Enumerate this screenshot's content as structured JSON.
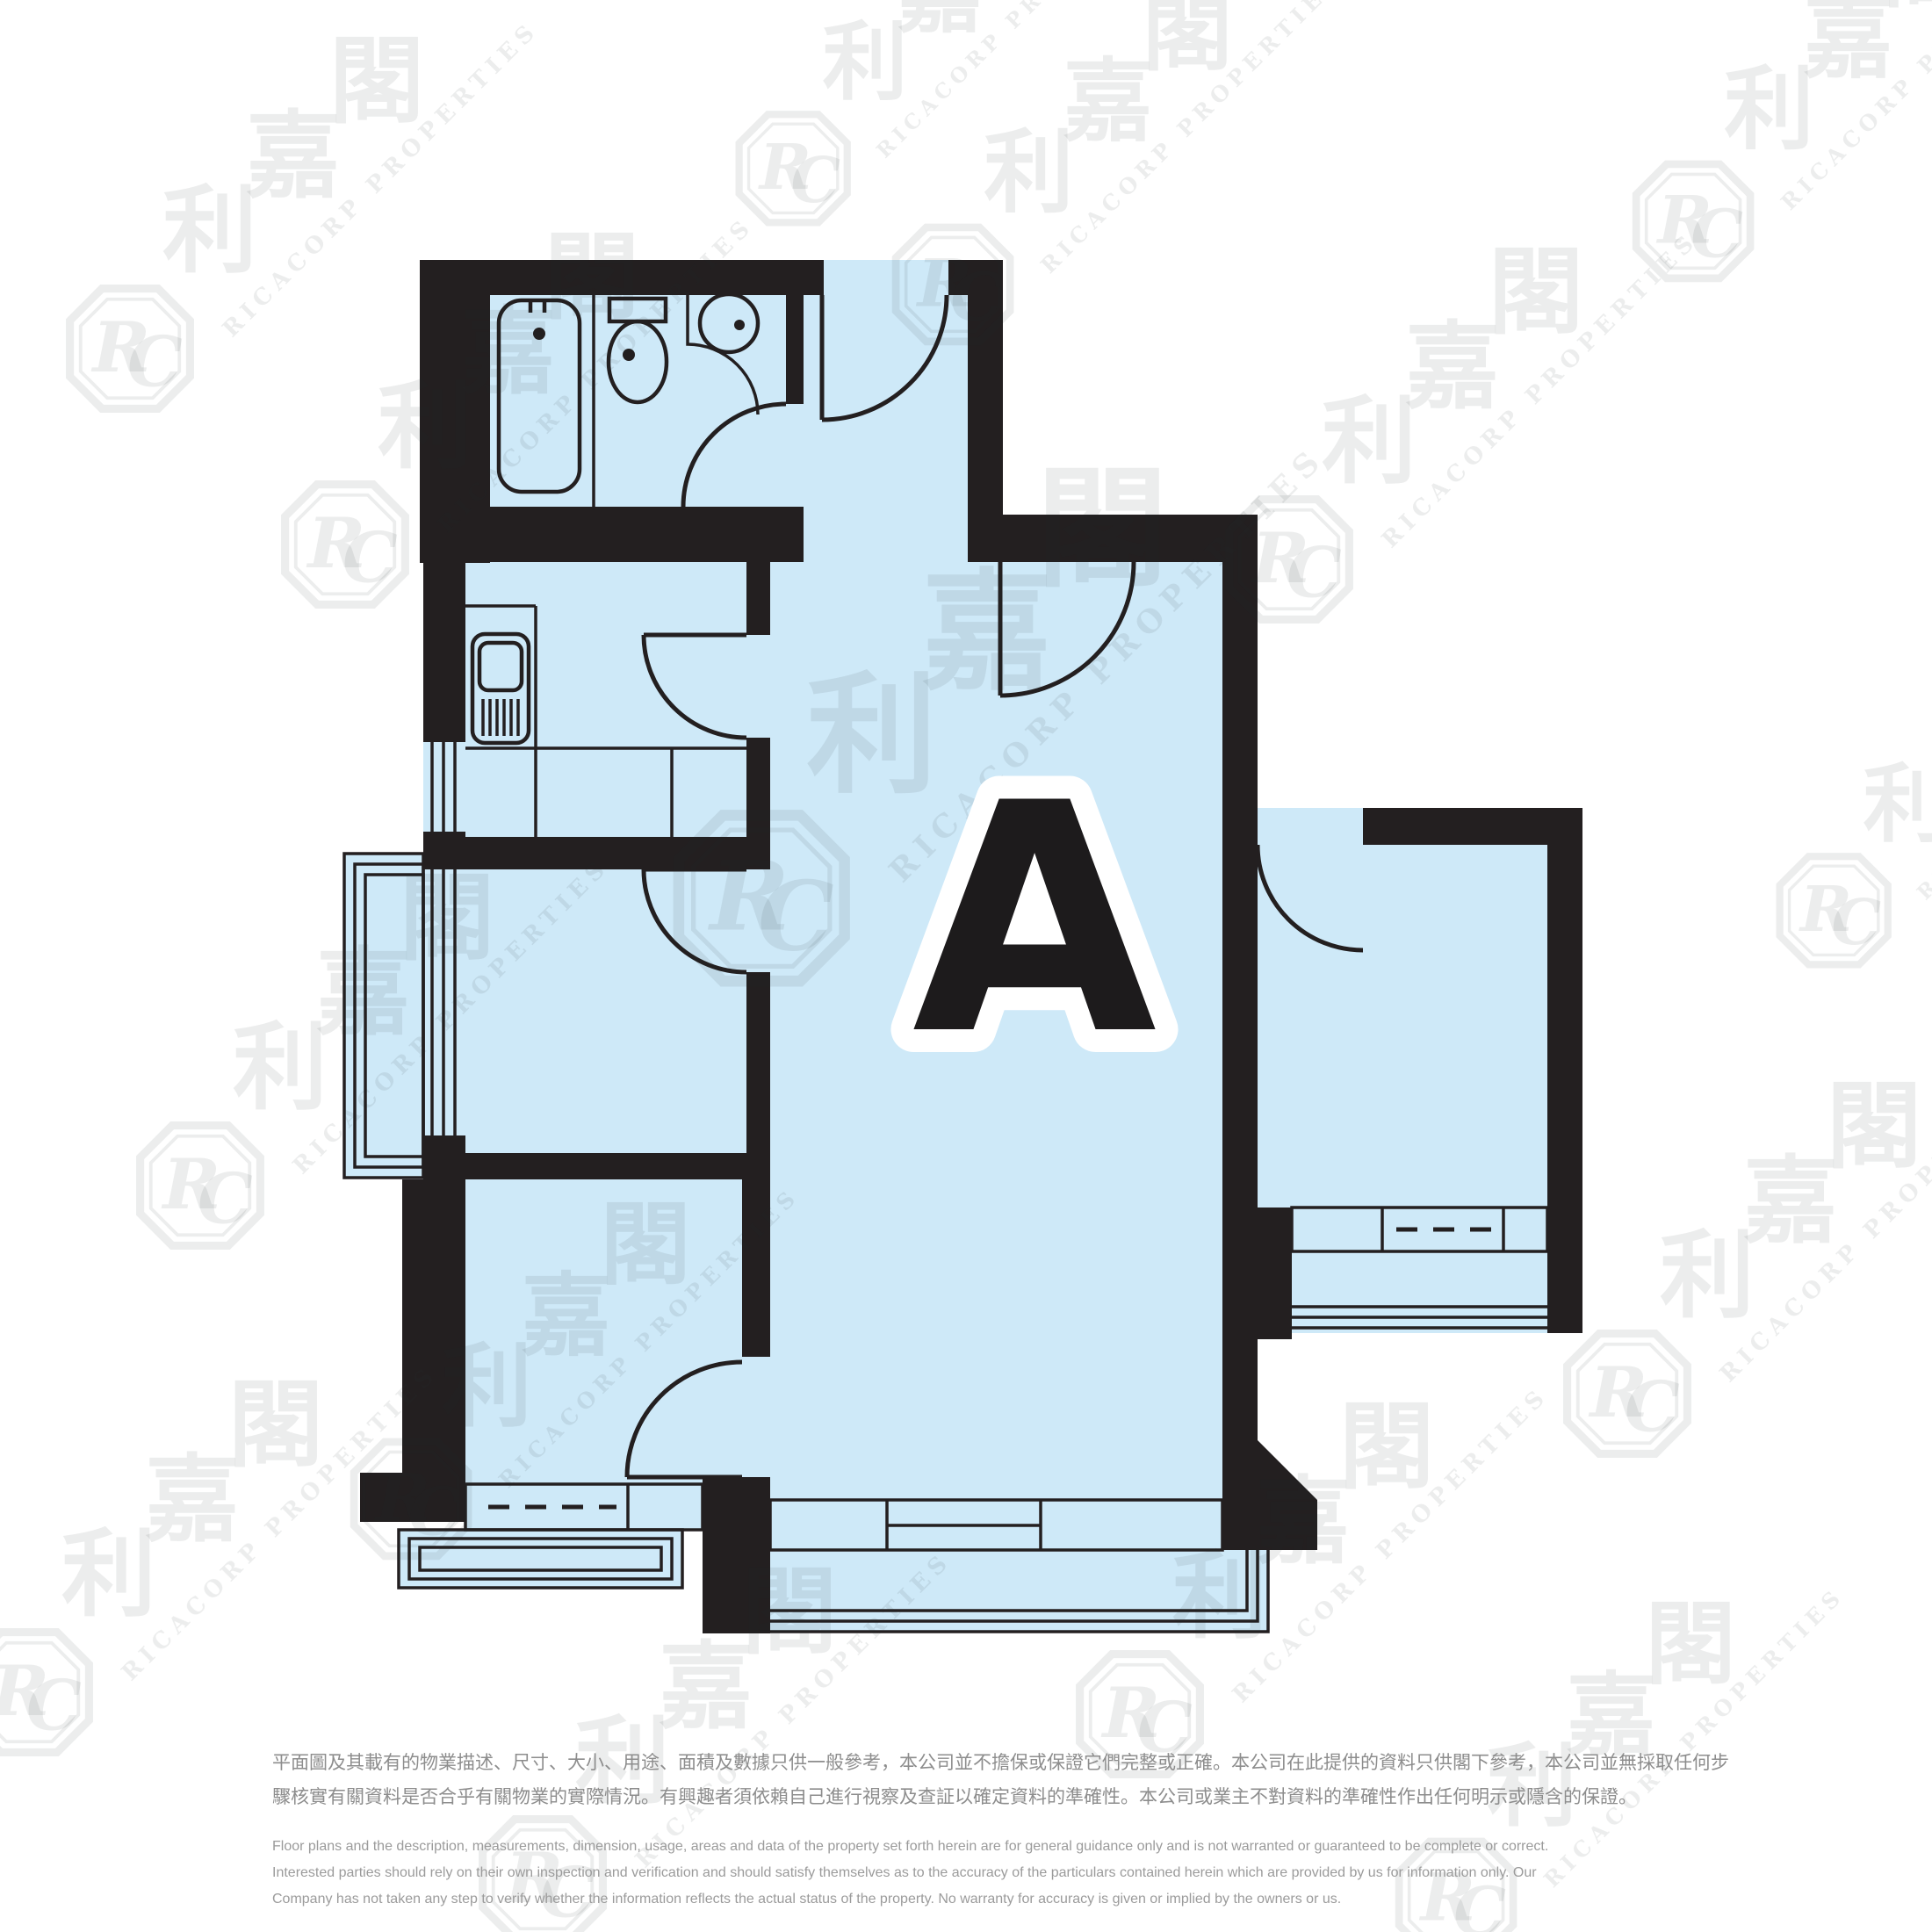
{
  "unit": {
    "label": "A"
  },
  "watermark": {
    "monogram": "RC",
    "cjk": "利嘉閣",
    "en": "RICACORP PROPERTIES"
  },
  "disclaimer": {
    "zh": [
      "平面圖及其載有的物業描述、尺寸、大小、用途、面積及數據只供一般參考，本公司並不擔保或保證它們完整或正確。本公司在此提供的資料只供閣下參考，本公司並無採取任何步",
      "驟核實有關資料是否合乎有關物業的實際情況。有興趣者須依賴自己進行視察及查証以確定資料的準確性。本公司或業主不對資料的準確性作出任何明示或隱含的保證。"
    ],
    "en": [
      "Floor plans and the description, measurements, dimension, usage, areas and data of the property set forth herein are for general guidance only and is not warranted or guaranteed to be complete or correct.",
      "Interested parties should rely on their own inspection and verification and should satisfy themselves as to the accuracy of the particulars contained herein which are provided by us for information only.  Our",
      "Company has not taken any step to verify whether the information reflects the actual status of the property.  No warranty for accuracy is given or implied by the owners or us."
    ]
  },
  "colors": {
    "floor": "#cee9f8",
    "wall": "#231f20",
    "label": "#1d1b1c"
  }
}
